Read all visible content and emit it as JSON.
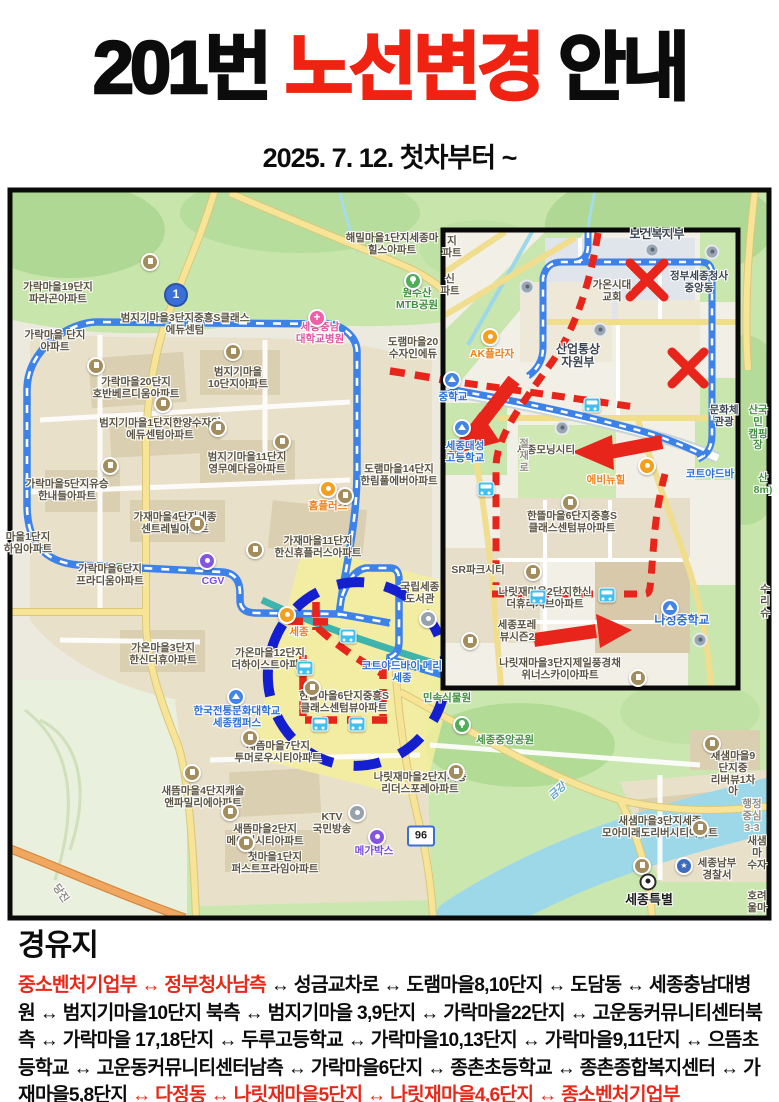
{
  "title": {
    "part1": "201번 ",
    "highlight": "노선변경",
    "part2": " 안내"
  },
  "subtitle": "2025. 7. 12. 첫차부터 ~",
  "stops": {
    "heading": "경유지",
    "red_start": "중소벤처기업부 ↔ 정부청사남측",
    "middle": " ↔ 성금교차로 ↔ 도램마을8,10단지 ↔ 도담동 ↔ 세종충남대병원 ↔ 범지기마을10단지 북측 ↔ 범지기마을 3,9단지 ↔ 가락마을22단지 ↔ 고운동커뮤니티센터북측 ↔ 가락마을 17,18단지 ↔ 두루고등학교 ↔ 가락마을10,13단지 ↔ 가락마을9,11단지 ↔ 으뜸초등학교 ↔ 고운동커뮤니티센터남측 ↔ 가락마을6단지 ↔ 종촌초등학교 ↔ 종촌종합복지센터 ↔ 가재마을5,8단지 ",
    "red_end": "↔ 다정동 ↔ 나릿재마을5단지 ↔ 나릿재마을4,6단지 ↔ 종소벤처기업부"
  },
  "colors": {
    "accent_red": "#e8291a",
    "old_route_blue": "#3d82e8",
    "ring_blue": "#1420d0"
  },
  "map": {
    "badge1": "1",
    "badge96": "96",
    "labels": [
      {
        "t": "가락마을19단지\n파라곤아파트",
        "x": 58,
        "y": 282
      },
      {
        "t": "가락마을 단지\n아파트",
        "x": 55,
        "y": 330
      },
      {
        "t": "범지기마을3단지중흥S클래스\n에듀센텀",
        "x": 185,
        "y": 313
      },
      {
        "t": "해밀마을1단지세종마\n힐스아파트",
        "x": 392,
        "y": 233
      },
      {
        "t": "원수산\nMTB공원",
        "x": 417,
        "y": 288,
        "cls": "green"
      },
      {
        "t": "도램마을20\n수자인에듀",
        "x": 413,
        "y": 337
      },
      {
        "t": "가락마을20단지\n호반베르디움아파트",
        "x": 136,
        "y": 377
      },
      {
        "t": "범지기마을\n10단지아파트",
        "x": 238,
        "y": 367
      },
      {
        "t": "범지기마을1단지한양수자인\n에듀센텀아파트",
        "x": 160,
        "y": 418
      },
      {
        "t": "범지기마을11단지\n영무예다음아파트",
        "x": 247,
        "y": 452
      },
      {
        "t": "도램마을14단지\n한림풀에버아파트",
        "x": 399,
        "y": 464
      },
      {
        "t": "가락마을5단지유승\n한내들아파트",
        "x": 67,
        "y": 479
      },
      {
        "t": "가재마을4단지세종\n센트레빌아파트",
        "x": 175,
        "y": 512
      },
      {
        "t": "홈플러스",
        "x": 328,
        "y": 501,
        "cls": "orange"
      },
      {
        "t": "가재마을11단지\n한신휴플러스아파트",
        "x": 318,
        "y": 536
      },
      {
        "t": "마을1단지\n하임아파트",
        "x": 28,
        "y": 532
      },
      {
        "t": "가락마을6단지\n프라디움아파트",
        "x": 110,
        "y": 564
      },
      {
        "t": "CGV",
        "x": 213,
        "y": 576,
        "cls": "purple"
      },
      {
        "t": "국립세종\n도서관",
        "x": 420,
        "y": 582
      },
      {
        "t": "가온마을3단지\n한신더휴아파트",
        "x": 163,
        "y": 643
      },
      {
        "t": "가온마을12단지\n더하이스트아파트",
        "x": 270,
        "y": 648
      },
      {
        "t": "세종",
        "x": 299,
        "y": 627,
        "cls": "orange"
      },
      {
        "t": "한뜰마을6단지중흥S\n클래스센텀뷰아파트",
        "x": 344,
        "y": 691
      },
      {
        "t": "코트야드바이 메리\n세종",
        "x": 402,
        "y": 661,
        "cls": "blue"
      },
      {
        "t": "한국전통문화대학교\n세종캠퍼스",
        "x": 237,
        "y": 706,
        "cls": "blue"
      },
      {
        "t": "새뜸마을7단지\n투머로우시티아파트",
        "x": 278,
        "y": 741
      },
      {
        "t": "세종중앙공원",
        "x": 505,
        "y": 735,
        "cls": "green"
      },
      {
        "t": "나릿재마을2단지세종\n리더스포레아파트",
        "x": 420,
        "y": 772
      },
      {
        "t": "새뜸마을4단지캐슬\n앤파밀리에아파트",
        "x": 203,
        "y": 786
      },
      {
        "t": "새뜸마을2단지\n메이저시티아파트",
        "x": 265,
        "y": 824
      },
      {
        "t": "KTV\n국민방송",
        "x": 332,
        "y": 812
      },
      {
        "t": "첫마을1단지\n퍼스트프라임아파트",
        "x": 275,
        "y": 852
      },
      {
        "t": "메가박스",
        "x": 374,
        "y": 846,
        "cls": "purple"
      },
      {
        "t": "민속식물원",
        "x": 447,
        "y": 693,
        "cls": "green"
      },
      {
        "t": "새샘마을9단지중\n리버뷰1차아",
        "x": 733,
        "y": 751
      },
      {
        "t": "새샘마을3단지세종\n모아미래도리버시티아파트",
        "x": 660,
        "y": 816
      },
      {
        "t": "행정중심\n3-3",
        "x": 752,
        "y": 799,
        "cls": "gray"
      },
      {
        "t": "세종남부\n경찰서",
        "x": 717,
        "y": 858
      },
      {
        "t": "새샘마\n수자",
        "x": 757,
        "y": 836
      },
      {
        "t": "세종특별",
        "x": 649,
        "y": 893,
        "cls": "dark",
        "fs": 13
      },
      {
        "t": "호려울마",
        "x": 757,
        "y": 891
      },
      {
        "t": "금강",
        "x": 558,
        "y": 786,
        "cls": "water",
        "rot": -42
      },
      {
        "t": "당진",
        "x": 60,
        "y": 888,
        "cls": "gray",
        "rot": 55
      },
      {
        "t": "세종충남\n대학교병원",
        "x": 320,
        "y": 322,
        "cls": "pink"
      },
      {
        "t": "중학교",
        "x": 453,
        "y": 392,
        "cls": "blue"
      },
      {
        "t": "보건복지부",
        "x": 657,
        "y": 228,
        "cls": "gov",
        "fs": 12
      },
      {
        "t": "정부세종청사\n중앙동",
        "x": 699,
        "y": 271,
        "cls": "gov"
      },
      {
        "t": "가온시대\n교회",
        "x": 612,
        "y": 280
      },
      {
        "t": "산업통상\n자원부",
        "x": 578,
        "y": 343,
        "cls": "gov",
        "fs": 12
      },
      {
        "t": "AK플라자",
        "x": 492,
        "y": 349,
        "cls": "orange"
      },
      {
        "t": "지\n파트",
        "x": 452,
        "y": 236
      },
      {
        "t": "신\n파트",
        "x": 450,
        "y": 274
      },
      {
        "t": "세종모닝시티",
        "x": 546,
        "y": 445
      },
      {
        "t": "세종대성\n고등학교",
        "x": 465,
        "y": 441,
        "cls": "blue"
      },
      {
        "t": "에비뉴힐",
        "x": 606,
        "y": 475,
        "cls": "orange"
      },
      {
        "t": "코트야드바",
        "x": 710,
        "y": 469,
        "cls": "blue"
      },
      {
        "t": "산\n8m)",
        "x": 763,
        "y": 473,
        "cls": "green"
      },
      {
        "t": "한뜰마을6단지중흥S\n클래스센텀뷰아파트",
        "x": 572,
        "y": 511
      },
      {
        "t": "SR파크시티",
        "x": 478,
        "y": 565
      },
      {
        "t": "나릿재마을2단지한신\n더휴리저브아파트",
        "x": 545,
        "y": 587
      },
      {
        "t": "세종포레\n뷰시즌2",
        "x": 517,
        "y": 620
      },
      {
        "t": "나성중학교",
        "x": 682,
        "y": 614,
        "cls": "blue",
        "fs": 12
      },
      {
        "t": "나릿재마을3단지제일풍경채\n위너스카이아파트",
        "x": 560,
        "y": 658
      },
      {
        "t": "문화체\n관광",
        "x": 724,
        "y": 405,
        "cls": "gov"
      },
      {
        "t": "산국민\n캠핑장",
        "x": 758,
        "y": 405,
        "cls": "green"
      },
      {
        "t": "수\n리슈",
        "x": 765,
        "y": 584
      },
      {
        "t": "절재로",
        "x": 522,
        "y": 438,
        "cls": "vert gray",
        "fs": 10
      }
    ],
    "icons": [
      {
        "k": "bus",
        "x": 348,
        "y": 636
      },
      {
        "k": "bus",
        "x": 305,
        "y": 668
      },
      {
        "k": "bus",
        "x": 320,
        "y": 724
      },
      {
        "k": "bus",
        "x": 357,
        "y": 724
      },
      {
        "k": "bus",
        "x": 592,
        "y": 405
      },
      {
        "k": "bus",
        "x": 486,
        "y": 489
      },
      {
        "k": "bus",
        "x": 538,
        "y": 597
      },
      {
        "k": "bus",
        "x": 607,
        "y": 595
      },
      {
        "k": "apt",
        "x": 150,
        "y": 262
      },
      {
        "k": "apt",
        "x": 233,
        "y": 352
      },
      {
        "k": "apt",
        "x": 96,
        "y": 366
      },
      {
        "k": "apt",
        "x": 163,
        "y": 404
      },
      {
        "k": "apt",
        "x": 110,
        "y": 466
      },
      {
        "k": "apt",
        "x": 218,
        "y": 428
      },
      {
        "k": "apt",
        "x": 282,
        "y": 442
      },
      {
        "k": "apt",
        "x": 345,
        "y": 496
      },
      {
        "k": "apt",
        "x": 197,
        "y": 524
      },
      {
        "k": "apt",
        "x": 255,
        "y": 550
      },
      {
        "k": "apt",
        "x": 312,
        "y": 688
      },
      {
        "k": "apt",
        "x": 250,
        "y": 738
      },
      {
        "k": "apt",
        "x": 192,
        "y": 773
      },
      {
        "k": "apt",
        "x": 230,
        "y": 812
      },
      {
        "k": "apt",
        "x": 246,
        "y": 843
      },
      {
        "k": "apt",
        "x": 456,
        "y": 772
      },
      {
        "k": "apt",
        "x": 712,
        "y": 744
      },
      {
        "k": "apt",
        "x": 700,
        "y": 828
      },
      {
        "k": "apt",
        "x": 642,
        "y": 866
      },
      {
        "k": "apt",
        "x": 570,
        "y": 503
      },
      {
        "k": "apt",
        "x": 533,
        "y": 572
      },
      {
        "k": "apt",
        "x": 470,
        "y": 641
      },
      {
        "k": "apt",
        "x": 638,
        "y": 678
      },
      {
        "k": "school",
        "x": 452,
        "y": 380
      },
      {
        "k": "school",
        "x": 462,
        "y": 428
      },
      {
        "k": "school",
        "x": 670,
        "y": 608
      },
      {
        "k": "school",
        "x": 236,
        "y": 697
      },
      {
        "k": "tree",
        "x": 413,
        "y": 281
      },
      {
        "k": "tree",
        "x": 462,
        "y": 725
      },
      {
        "k": "hosp",
        "x": 317,
        "y": 318
      },
      {
        "k": "police",
        "x": 684,
        "y": 866
      },
      {
        "k": "target",
        "x": 648,
        "y": 882
      },
      {
        "k": "orange",
        "x": 328,
        "y": 489
      },
      {
        "k": "orange",
        "x": 287,
        "y": 615
      },
      {
        "k": "orange",
        "x": 490,
        "y": 337
      },
      {
        "k": "orange",
        "x": 647,
        "y": 466
      },
      {
        "k": "purple",
        "x": 207,
        "y": 561
      },
      {
        "k": "purple",
        "x": 377,
        "y": 837
      },
      {
        "k": "ktv",
        "x": 357,
        "y": 813
      },
      {
        "k": "lib",
        "x": 428,
        "y": 619
      },
      {
        "k": "gov",
        "x": 652,
        "y": 250
      },
      {
        "k": "gov",
        "x": 712,
        "y": 252
      },
      {
        "k": "gov",
        "x": 600,
        "y": 330
      },
      {
        "k": "gov",
        "x": 562,
        "y": 428
      },
      {
        "k": "gov",
        "x": 527,
        "y": 287
      },
      {
        "k": "gov",
        "x": 700,
        "y": 640
      }
    ]
  }
}
